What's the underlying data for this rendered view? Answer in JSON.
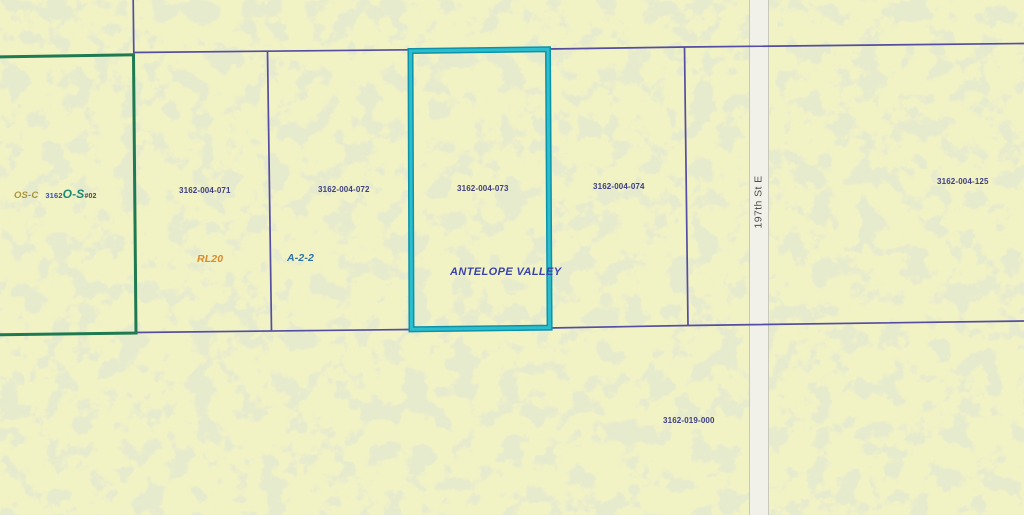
{
  "map": {
    "area_label": "ANTELOPE VALLEY",
    "street_label": "197th St E",
    "zoning_labels": {
      "os_c": "OS-C",
      "os_case_prefix": "3162",
      "os_case_zone": "O-S",
      "os_case_suffix": "#02",
      "rl20": "RL20",
      "a_2_2": "A-2-2"
    },
    "parcel_numbers": {
      "p071": "3162-004-071",
      "p072": "3162-004-072",
      "p073": "3162-004-073",
      "p074": "3162-004-074",
      "p125": "3162-004-125",
      "p019": "3162-019-000"
    },
    "colors": {
      "background": "#f2f3c5",
      "texture_blotch": "#ccd39b",
      "parcel_line": "#544da0",
      "selected_parcel_outline": "#1fb0c4",
      "open_space_outline": "#1e7a50",
      "road_fill": "#f1f1ea",
      "parcel_number_text": "#3e3e80",
      "area_label_text": "#3843b0",
      "rl20_text": "#d98b2e",
      "a22_text": "#2d74a4",
      "street_text": "#4f4f4f"
    }
  }
}
